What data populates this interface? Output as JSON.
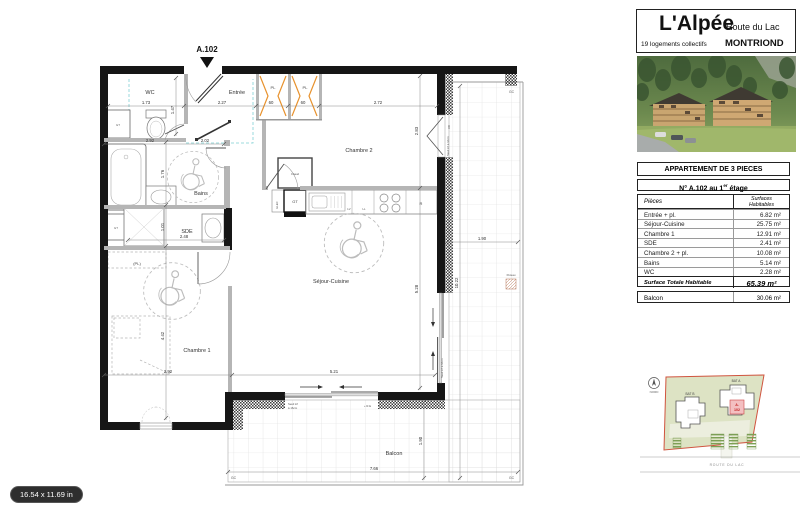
{
  "page": {
    "size_badge": "16.54 x 11.69 in"
  },
  "title_block": {
    "project": "L'Alpée",
    "street": "Route du Lac",
    "subtitle": "19 logements collectifs",
    "city": "MONTRIOND"
  },
  "apartment_table": {
    "title": "APPARTEMENT DE 3 PIECES",
    "subtitle_pre": "N° A.102 au 1",
    "subtitle_sup": "er",
    "subtitle_post": " étage",
    "col_pieces": "Pièces",
    "col_surface1": "Surfaces",
    "col_surface2": "Habitables",
    "rows": [
      {
        "label": "Entrée + pl.",
        "value": "6.82 m²"
      },
      {
        "label": "Séjour-Cuisine",
        "value": "25.75 m²"
      },
      {
        "label": "Chambre 1",
        "value": "12.91 m²"
      },
      {
        "label": "SDE",
        "value": "2.41 m²"
      },
      {
        "label": "Chambre 2 + pl.",
        "value": "10.08 m²"
      },
      {
        "label": "Bains",
        "value": "5.14 m²"
      },
      {
        "label": "WC",
        "value": "2.28 m²"
      }
    ],
    "total_label": "Surface Totale Habitable",
    "total_value": "65.39 m²",
    "balcon_label": "Balcon",
    "balcon_value": "30.06 m²"
  },
  "plan": {
    "unit_label": "A.102",
    "rooms": {
      "wc": "WC",
      "entree": "Entrée",
      "pl1": "PL",
      "pl2": "PL",
      "chambre2": "Chambre 2",
      "bains": "Bains",
      "sde": "SDE",
      "chambre1": "Chambre 1",
      "sejour": "Séjour-Cuisine",
      "balcon": "Balcon",
      "pl_ch1": "(PL)",
      "chaud": "Chaud",
      "gt1": "GT",
      "gt2": "GT",
      "gt3": "GT",
      "elec": "ELEC",
      "lv": "LV",
      "ll": "LL",
      "refrig": "R"
    },
    "dims": {
      "d173": "1.73",
      "d147": "1.47",
      "d227": "2.27",
      "d60a": "60",
      "d60b": "60",
      "d272": "2.72",
      "d283": "2.83",
      "d528": "5.28",
      "d292a": "2.92",
      "d202": "2.02",
      "d176": "1.76",
      "d248": "2.48",
      "d101": "1.01",
      "d442": "4.42",
      "d292b": "2.92",
      "d521": "5.21",
      "d766": "7.66",
      "d190a": "1.90",
      "d190b": "1.90",
      "d1022": "10.22"
    },
    "annotations": {
      "gc": "GC",
      "poteau": "Poteau",
      "seuil1": "Seuil inf",
      "seuil2": "à 16cm",
      "seuil_full": "Seuil inf à 16cm",
      "re": "+ R.E",
      "vr": "VR"
    }
  },
  "site_plan": {
    "bat_a": "BAT A",
    "bat_b": "BAT B",
    "unit_a": "A.",
    "unit_num": "102",
    "road": "ROUTE DU LAC",
    "north": "NORD"
  }
}
